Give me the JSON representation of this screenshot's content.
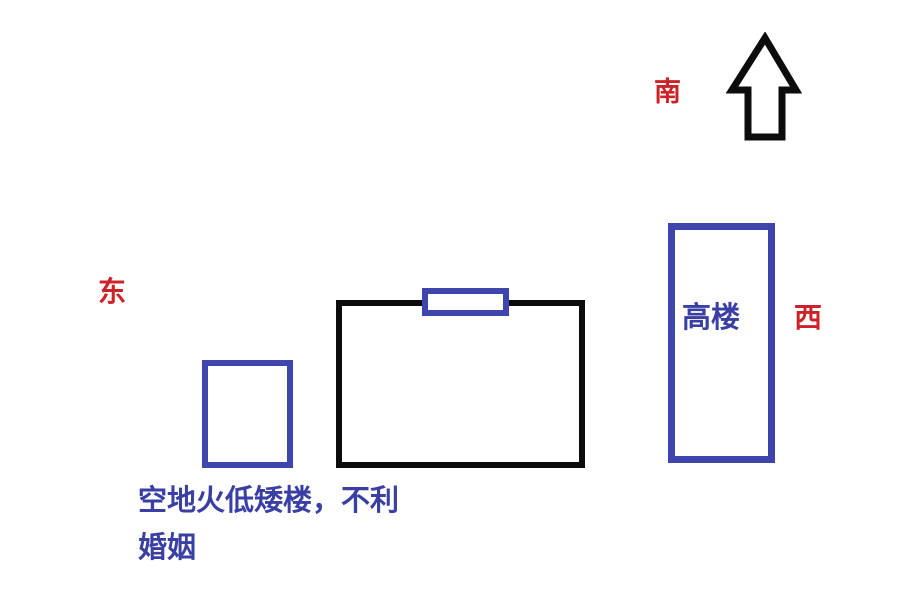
{
  "compass": {
    "south": "南",
    "east": "东",
    "west": "西",
    "arrow_icon": "up-arrow-icon",
    "arrow_direction": "up"
  },
  "diagram": {
    "tall_building_label": "高楼",
    "caption_line1": "空地火低矮楼，不利",
    "caption_line2": "婚姻"
  },
  "colors": {
    "direction-red": "#cd2328",
    "shape-blue": "#3e46ae",
    "caption-blue": "#3a3fa3",
    "outline-black": "#0c0c0c"
  }
}
